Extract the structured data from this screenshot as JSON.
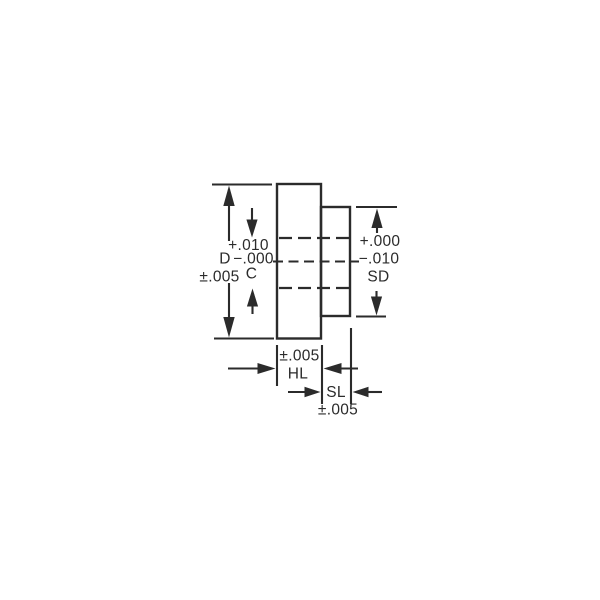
{
  "drawing": {
    "description": "hub-shaft-dimension-drawing",
    "colors": {
      "background": "#ffffff",
      "line": "#2b2b2b"
    },
    "outer_diameter": {
      "letter": "D",
      "tolerance": "±.005"
    },
    "bore": {
      "letter": "C",
      "tol_plus": "+.010",
      "tol_minus": "−.000"
    },
    "shaft_diameter": {
      "letter": "SD",
      "tol_plus": "+.000",
      "tol_minus": "−.010"
    },
    "hub_length": {
      "letter": "HL",
      "tolerance": "±.005"
    },
    "shaft_length": {
      "letter": "SL",
      "tolerance": "±.005"
    }
  }
}
